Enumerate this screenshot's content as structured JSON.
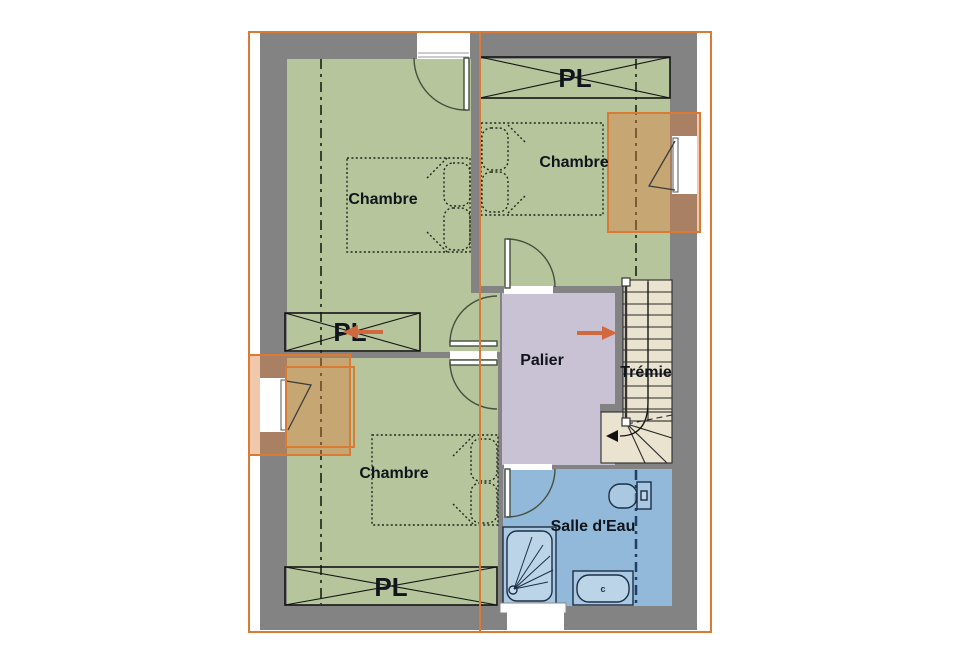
{
  "plan": {
    "rooms": {
      "chambre1": {
        "label": "Chambre"
      },
      "chambre2": {
        "label": "Chambre"
      },
      "chambre3": {
        "label": "Chambre"
      },
      "palier": {
        "label": "Palier"
      },
      "tremie": {
        "label": "Trémie"
      },
      "salle_deau": {
        "label": "Salle d'Eau"
      }
    },
    "closets": {
      "top": {
        "label": "PL"
      },
      "middle": {
        "label": "PL"
      },
      "bottom": {
        "label": "PL"
      }
    },
    "fixtures": {
      "sink_mark": "c"
    },
    "colors": {
      "wall_gray": "#838383",
      "bedroom_green": "#b6c59c",
      "landing_lavender": "#c9c2d4",
      "bathroom_blue": "#92b9d9",
      "stairs_beige": "#e9e3cf",
      "highlight_orange": "#d97a35",
      "arrow_orange": "#d2693e",
      "label_text": "#10141c"
    }
  }
}
